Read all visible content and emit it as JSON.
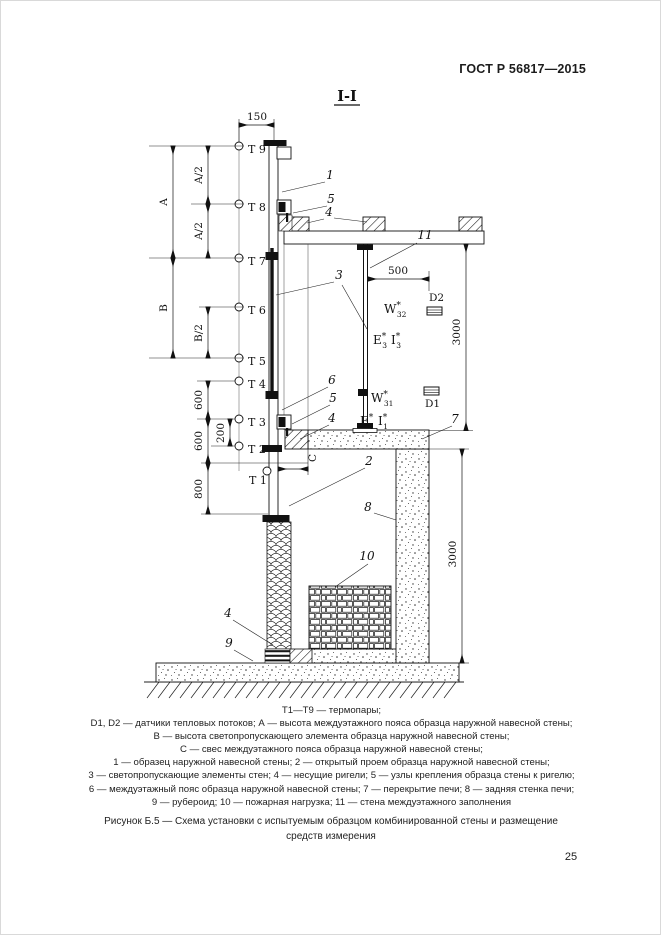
{
  "page": {
    "header": "ГОСТ Р 56817—2015",
    "page_number": "25"
  },
  "figure": {
    "section_label": "I-I",
    "caption_line1": "Рисунок Б.5 — Схема установки с испытуемым образцом комбинированной стены и размещение",
    "caption_line2": "средств измерения",
    "legend_lines": [
      "Т1—Т9 — термопары;",
      "D1, D2 — датчики тепловых потоков; А — высота междуэтажного пояса образца наружной навесной стены;",
      "В — высота светопропускающего элемента образца наружной навесной стены;",
      "С — свес междуэтажного пояса образца наружной навесной стены;",
      "1 — образец наружной навесной стены; 2 — открытый проем образца наружной навесной стены;",
      "3 — светопропускающие элементы стен; 4 — несущие ригели; 5 — узлы крепления образца стены к ригелю;",
      "6 — междуэтажный пояс образца наружной навесной стены; 7 — перекрытие печи; 8 — задняя стенка печи;",
      "9 — рубероид; 10 — пожарная нагрузка; 11 — стена междуэтажного заполнения"
    ]
  },
  "diagram": {
    "thermocouples": [
      "Т 9",
      "Т 8",
      "Т 7",
      "Т 6",
      "Т 5",
      "Т 4",
      "Т 3",
      "Т 2",
      "Т 1"
    ],
    "dimensions": {
      "top_width": "150",
      "offset_500": "500",
      "height_3000": "3000",
      "a": "A",
      "a_half": "A/2",
      "b": "B",
      "b_half": "B/2",
      "v600": "600",
      "v200": "200",
      "v800": "800",
      "c": "C"
    },
    "sensors": {
      "d1": "D1",
      "d2": "D2"
    },
    "measures": {
      "w_upper": {
        "base": "W",
        "sup": "*",
        "sub": "32"
      },
      "e_upper": {
        "base": "E",
        "sup": "*",
        "sub": "3"
      },
      "i_upper": {
        "base": "I",
        "sup": "*",
        "sub": "3"
      },
      "w_lower": {
        "base": "W",
        "sup": "*",
        "sub": "31"
      },
      "e_lower": {
        "base": "E",
        "sup": "*",
        "sub": "1"
      },
      "i_lower": {
        "base": "I",
        "sup": "*",
        "sub": "1"
      }
    },
    "callouts": {
      "c1": "1",
      "c2": "2",
      "c3": "3",
      "c4": "4",
      "c5": "5",
      "c6": "6",
      "c7": "7",
      "c8": "8",
      "c9": "9",
      "c10": "10",
      "c11": "11"
    }
  }
}
